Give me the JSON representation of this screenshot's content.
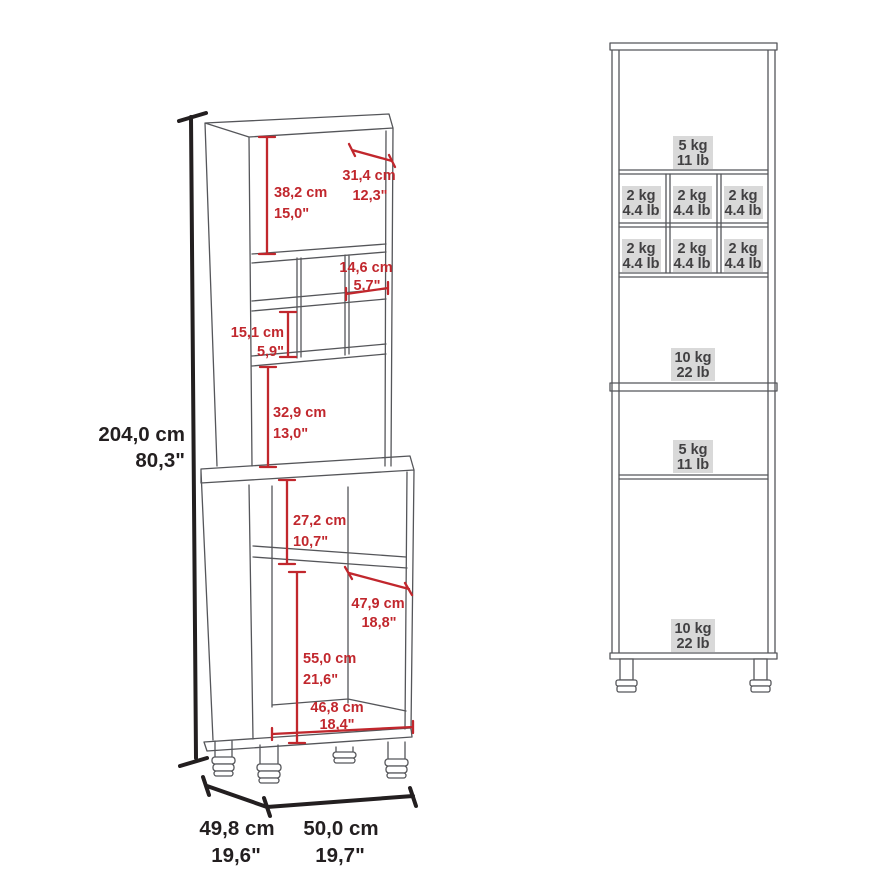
{
  "diagram_type": "furniture dimension and load-capacity diagram (tall bar cabinet with wine cubbies)",
  "colors": {
    "dimension_red": "#c1272d",
    "outline_gray": "#55565a",
    "text_dark": "#231f20",
    "load_label_bg": "#d9d9d9",
    "load_label_text": "#414042"
  },
  "left_view": {
    "overall": {
      "height_cm": "204,0 cm",
      "height_in": "80,3\"",
      "depth_cm": "49,8 cm",
      "depth_in": "19,6\"",
      "width_cm": "50,0 cm",
      "width_in": "19,7\""
    },
    "dimensions": {
      "hutch_opening_height": {
        "cm": "38,2 cm",
        "in": "15,0\""
      },
      "top_depth": {
        "cm": "31,4 cm",
        "in": "12,3\""
      },
      "cubby_width": {
        "cm": "14,6 cm",
        "in": "5,7\""
      },
      "cubby_height": {
        "cm": "15,1 cm",
        "in": "5,9\""
      },
      "middle_opening_height": {
        "cm": "32,9 cm",
        "in": "13,0\""
      },
      "base_opening_height": {
        "cm": "27,2 cm",
        "in": "10,7\""
      },
      "interior_depth": {
        "cm": "47,9 cm",
        "in": "18,8\""
      },
      "lower_compartment_height": {
        "cm": "55,0 cm",
        "in": "21,6\""
      },
      "interior_width": {
        "cm": "46,8 cm",
        "in": "18,4\""
      }
    }
  },
  "right_view": {
    "load_capacities": {
      "top_shelf": {
        "kg": "5 kg",
        "lb": "11 lb"
      },
      "wine_cubby": {
        "kg": "2 kg",
        "lb": "4.4 lb"
      },
      "middle_shelf": {
        "kg": "10 kg",
        "lb": "22 lb"
      },
      "base_shelf": {
        "kg": "5 kg",
        "lb": "11 lb"
      },
      "bottom_shelf": {
        "kg": "10 kg",
        "lb": "22 lb"
      }
    }
  }
}
